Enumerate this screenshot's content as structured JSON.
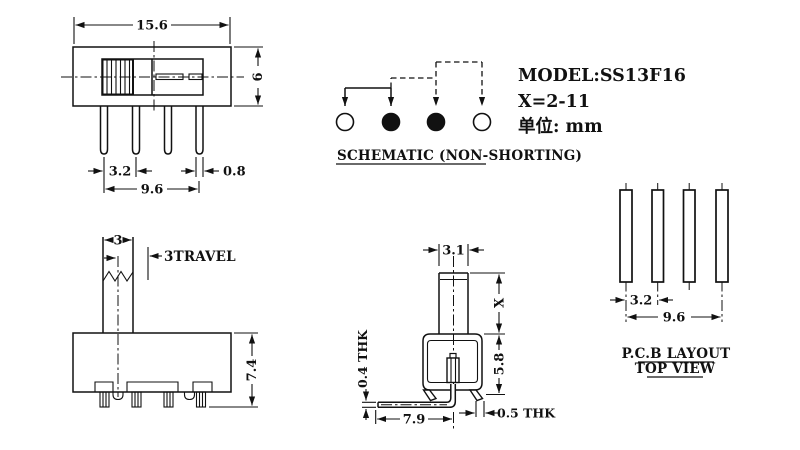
{
  "colors": {
    "line": "#111111",
    "bg": "#ffffff"
  },
  "title_block": {
    "model": "MODEL:SS13F16",
    "x_range": "X=2-11",
    "unit": "单位: mm"
  },
  "schematic": {
    "label": "SCHEMATIC (NON-SHORTING)",
    "poles": [
      "open",
      "filled",
      "filled",
      "open"
    ]
  },
  "front_view": {
    "dim_width": "15.6",
    "dim_height": "6",
    "dim_pitch": "3.2",
    "dim_span": "9.6",
    "dim_pin_width": "0.8"
  },
  "side_view": {
    "dim_knob": "3",
    "travel_label": "3TRAVEL",
    "dim_height": "7.4"
  },
  "section_view": {
    "dim_stem": "3.1",
    "dim_x": "X",
    "dim_body": "5.8",
    "thk_pin": "0.4 THK",
    "dim_pin_len": "7.9",
    "thk_foot": "0.5 THK"
  },
  "pcb_layout": {
    "title": "P.C.B LAYOUT",
    "subtitle": "TOP VIEW",
    "dim_pitch": "3.2",
    "dim_span": "9.6"
  }
}
